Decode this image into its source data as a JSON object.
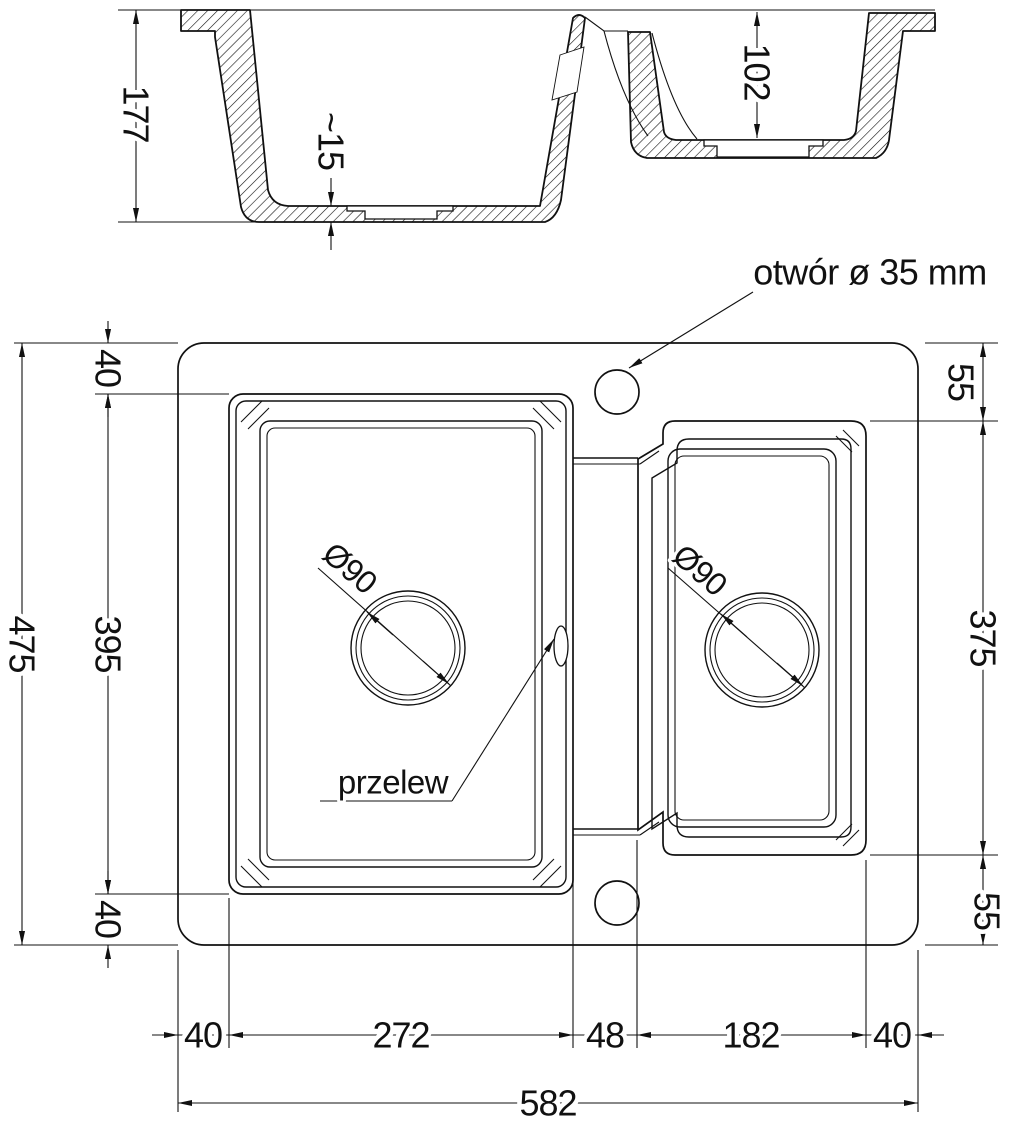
{
  "section": {
    "depth_main": "177",
    "floor_thickness": "~15",
    "depth_small": "102"
  },
  "plan": {
    "faucet_hole_label": "otwór ø 35 mm",
    "overflow_label": "przelew",
    "drain_left": "Ø90",
    "drain_right": "Ø90",
    "height_total": "475",
    "top_margin": "40",
    "bowl1_height": "395",
    "bottom_margin": "40",
    "right_top_margin": "55",
    "bowl2_height": "375",
    "right_bottom_margin": "55",
    "left_margin": "40",
    "bowl1_width": "272",
    "divider_width": "48",
    "bowl2_width": "182",
    "right_margin": "40",
    "width_total": "582"
  },
  "colors": {
    "line": "#111111",
    "background": "#ffffff"
  }
}
